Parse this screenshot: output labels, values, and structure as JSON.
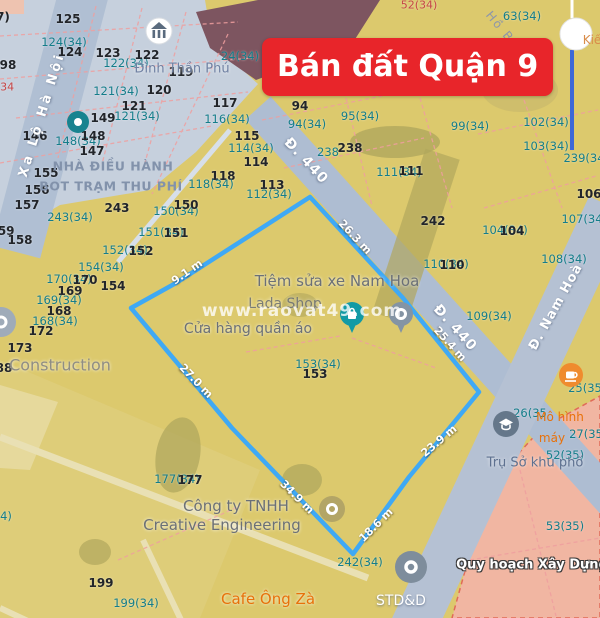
{
  "banner": {
    "label": "Bán đất Quận 9",
    "bg_color": "#e8252a",
    "text_color": "#ffffff"
  },
  "watermark": {
    "text": "www.raovat49.com"
  },
  "legend": {
    "planning_label": "Quy hoạch Xây Dựng"
  },
  "streets": {
    "xa_lo_ha_noi": "Xa Lộ Hà Nội",
    "d440_upper": "Đ. 440",
    "d440_lower": "Đ. 440",
    "nam_hoa": "Đ. Nam Hoà",
    "ho_ba_phan": "Hồ Bá Phấn"
  },
  "places": {
    "dinh_than_phu": "Đình Thần Phú",
    "nha_dieu_hanh_line1": "NHÀ ĐIỀU HÀNH",
    "nha_dieu_hanh_line2": "BOT TRẠM THU PHÍ",
    "construction": "Construction",
    "tiem_sua_xe": "Tiệm sửa xe Nam Hoa",
    "shop_partial": "Lada Shop",
    "cua_hang_quan_ao": "Cửa hàng quần áo",
    "cong_ty_line1": "Công ty TNHH",
    "cong_ty_line2": "Creative Engineering",
    "cafe_ong_za": "Cafe Ông Zà",
    "std": "STD&D",
    "tru_so_khu_pho": "Trụ Sở khu phố",
    "mo_hinh_line1": "Mô hình",
    "mo_hinh_line2": "máy",
    "kie_fragment": "Kiế",
    "quy_hoach": "Quy hoạch Xây Dựng"
  },
  "boundary": {
    "color": "#3fa9f5",
    "points": "310,197 403,298 479,392 409,477 353,554 232,428 131,308 176,283",
    "segments": [
      {
        "t": "26.3 m",
        "x": 355,
        "y": 237,
        "r": 47
      },
      {
        "t": "25.4 m",
        "x": 450,
        "y": 344,
        "r": 48
      },
      {
        "t": "23.9 m",
        "x": 439,
        "y": 441,
        "r": -40
      },
      {
        "t": "18.6 m",
        "x": 376,
        "y": 525,
        "r": -45
      },
      {
        "t": "34.9 m",
        "x": 297,
        "y": 497,
        "r": 45
      },
      {
        "t": "27.0 m",
        "x": 196,
        "y": 381,
        "r": 46
      },
      {
        "t": "9.1 m",
        "x": 187,
        "y": 272,
        "r": -35
      }
    ]
  },
  "parcels": [
    {
      "t": "7)",
      "x": 3,
      "y": 17,
      "k": "b"
    },
    {
      "t": "125",
      "x": 68,
      "y": 19,
      "k": "b"
    },
    {
      "t": "124(34)",
      "x": 64,
      "y": 42,
      "k": "t"
    },
    {
      "t": "124",
      "x": 70,
      "y": 52,
      "k": "b"
    },
    {
      "t": "123",
      "x": 108,
      "y": 53,
      "k": "b"
    },
    {
      "t": "122(34)",
      "x": 126,
      "y": 63,
      "k": "t"
    },
    {
      "t": "122",
      "x": 147,
      "y": 55,
      "k": "b"
    },
    {
      "t": "119",
      "x": 181,
      "y": 72,
      "k": "b"
    },
    {
      "t": "121(34)",
      "x": 116,
      "y": 91,
      "k": "t"
    },
    {
      "t": "120",
      "x": 159,
      "y": 90,
      "k": "b"
    },
    {
      "t": "121",
      "x": 134,
      "y": 106,
      "k": "b"
    },
    {
      "t": "121(34)",
      "x": 137,
      "y": 116,
      "k": "t"
    },
    {
      "t": "149",
      "x": 103,
      "y": 118,
      "k": "b"
    },
    {
      "t": "98",
      "x": 8,
      "y": 65,
      "k": "b"
    },
    {
      "t": "(34",
      "x": 5,
      "y": 87,
      "k": "r"
    },
    {
      "t": "146",
      "x": 35,
      "y": 136,
      "k": "b"
    },
    {
      "t": "148(34)",
      "x": 78,
      "y": 141,
      "k": "t"
    },
    {
      "t": "148",
      "x": 93,
      "y": 136,
      "k": "b"
    },
    {
      "t": "147",
      "x": 92,
      "y": 151,
      "k": "b"
    },
    {
      "t": "117",
      "x": 225,
      "y": 103,
      "k": "b"
    },
    {
      "t": "116(34)",
      "x": 227,
      "y": 119,
      "k": "t"
    },
    {
      "t": "115",
      "x": 247,
      "y": 136,
      "k": "b"
    },
    {
      "t": "114(34)",
      "x": 251,
      "y": 148,
      "k": "t"
    },
    {
      "t": "114",
      "x": 256,
      "y": 162,
      "k": "b"
    },
    {
      "t": "118",
      "x": 223,
      "y": 176,
      "k": "b"
    },
    {
      "t": "118(34)",
      "x": 211,
      "y": 184,
      "k": "t"
    },
    {
      "t": "113",
      "x": 272,
      "y": 185,
      "k": "b"
    },
    {
      "t": "112(34)",
      "x": 269,
      "y": 194,
      "k": "t"
    },
    {
      "t": "155",
      "x": 46,
      "y": 173,
      "k": "b"
    },
    {
      "t": "156",
      "x": 37,
      "y": 190,
      "k": "b"
    },
    {
      "t": "157",
      "x": 27,
      "y": 205,
      "k": "b"
    },
    {
      "t": "159",
      "x": 2,
      "y": 231,
      "k": "b"
    },
    {
      "t": "158",
      "x": 20,
      "y": 240,
      "k": "b"
    },
    {
      "t": "243(34)",
      "x": 70,
      "y": 217,
      "k": "t"
    },
    {
      "t": "243",
      "x": 117,
      "y": 208,
      "k": "b"
    },
    {
      "t": "150(34)",
      "x": 176,
      "y": 211,
      "k": "t"
    },
    {
      "t": "150",
      "x": 186,
      "y": 205,
      "k": "b"
    },
    {
      "t": "151(34)",
      "x": 161,
      "y": 232,
      "k": "t"
    },
    {
      "t": "151",
      "x": 176,
      "y": 233,
      "k": "b"
    },
    {
      "t": "152(34)",
      "x": 125,
      "y": 250,
      "k": "t"
    },
    {
      "t": "152",
      "x": 141,
      "y": 251,
      "k": "b"
    },
    {
      "t": "154(34)",
      "x": 101,
      "y": 267,
      "k": "t"
    },
    {
      "t": "170(34)",
      "x": 69,
      "y": 279,
      "k": "t"
    },
    {
      "t": "170",
      "x": 85,
      "y": 280,
      "k": "b"
    },
    {
      "t": "154",
      "x": 113,
      "y": 286,
      "k": "b"
    },
    {
      "t": "169",
      "x": 70,
      "y": 291,
      "k": "b"
    },
    {
      "t": "169(34)",
      "x": 59,
      "y": 300,
      "k": "t"
    },
    {
      "t": "168",
      "x": 59,
      "y": 311,
      "k": "b"
    },
    {
      "t": "168(34)",
      "x": 55,
      "y": 321,
      "k": "t"
    },
    {
      "t": "172",
      "x": 41,
      "y": 331,
      "k": "b"
    },
    {
      "t": "173",
      "x": 20,
      "y": 348,
      "k": "b"
    },
    {
      "t": "88",
      "x": 4,
      "y": 368,
      "k": "b"
    },
    {
      "t": "52(34)",
      "x": 419,
      "y": 5,
      "k": "r"
    },
    {
      "t": "24(34)",
      "x": 240,
      "y": 56,
      "k": "t"
    },
    {
      "t": "63(34)",
      "x": 522,
      "y": 16,
      "k": "t"
    },
    {
      "t": "100(34)",
      "x": 518,
      "y": 88,
      "k": "t"
    },
    {
      "t": "94",
      "x": 300,
      "y": 106,
      "k": "b"
    },
    {
      "t": "94(34)",
      "x": 307,
      "y": 124,
      "k": "t"
    },
    {
      "t": "95(34)",
      "x": 360,
      "y": 116,
      "k": "t"
    },
    {
      "t": "99(34)",
      "x": 470,
      "y": 126,
      "k": "t"
    },
    {
      "t": "102(34)",
      "x": 546,
      "y": 122,
      "k": "t"
    },
    {
      "t": "103(34)",
      "x": 546,
      "y": 146,
      "k": "t"
    },
    {
      "t": "239(34",
      "x": 584,
      "y": 158,
      "k": "t"
    },
    {
      "t": "238",
      "x": 328,
      "y": 152,
      "k": "t"
    },
    {
      "t": "238",
      "x": 350,
      "y": 148,
      "k": "b"
    },
    {
      "t": "111(34)",
      "x": 399,
      "y": 172,
      "k": "t"
    },
    {
      "t": "111",
      "x": 411,
      "y": 171,
      "k": "b"
    },
    {
      "t": "106",
      "x": 589,
      "y": 194,
      "k": "b"
    },
    {
      "t": "107(34",
      "x": 582,
      "y": 219,
      "k": "t"
    },
    {
      "t": "242",
      "x": 433,
      "y": 221,
      "k": "b"
    },
    {
      "t": "104(34)",
      "x": 505,
      "y": 230,
      "k": "t"
    },
    {
      "t": "104",
      "x": 512,
      "y": 231,
      "k": "b"
    },
    {
      "t": "110(34)",
      "x": 446,
      "y": 264,
      "k": "t"
    },
    {
      "t": "110",
      "x": 452,
      "y": 265,
      "k": "b"
    },
    {
      "t": "108(34)",
      "x": 564,
      "y": 259,
      "k": "t"
    },
    {
      "t": "109(34)",
      "x": 489,
      "y": 316,
      "k": "t"
    },
    {
      "t": "153(34)",
      "x": 318,
      "y": 364,
      "k": "t"
    },
    {
      "t": "153",
      "x": 315,
      "y": 374,
      "k": "b"
    },
    {
      "t": "25(35",
      "x": 585,
      "y": 388,
      "k": "t"
    },
    {
      "t": "26(35",
      "x": 530,
      "y": 413,
      "k": "t"
    },
    {
      "t": "27(35",
      "x": 586,
      "y": 434,
      "k": "t"
    },
    {
      "t": "52(35)",
      "x": 565,
      "y": 455,
      "k": "t"
    },
    {
      "t": "53(35)",
      "x": 565,
      "y": 526,
      "k": "t"
    },
    {
      "t": "177(34)",
      "x": 177,
      "y": 479,
      "k": "t"
    },
    {
      "t": "177",
      "x": 190,
      "y": 480,
      "k": "b"
    },
    {
      "t": "4)",
      "x": 6,
      "y": 516,
      "k": "t"
    },
    {
      "t": "199",
      "x": 101,
      "y": 583,
      "k": "b"
    },
    {
      "t": "199(34)",
      "x": 136,
      "y": 603,
      "k": "t"
    },
    {
      "t": "242(34)",
      "x": 360,
      "y": 562,
      "k": "t"
    }
  ],
  "colors": {
    "map_yellow": "#dcc96d",
    "zone_blue_gray": "#c6d0dd",
    "street_gray_blue": "#aebdd2",
    "building_maroon": "#7d5560",
    "planning_pink": "#f1b6a2",
    "boundary_blue": "#3fa9f5",
    "banner_red": "#e8252a",
    "parcel_teal": "#147d8a",
    "poi_orange": "#e8710a",
    "marker_line_blue": "#3d68d8",
    "cadastral_dash_red": "#ef9f9f"
  },
  "icons": [
    "temple-icon",
    "poi-dot-icon",
    "shopping-pin-icon",
    "poi-pin-icon",
    "coffee-icon",
    "school-icon",
    "poi-circle-icon",
    "location-marker-icon"
  ]
}
